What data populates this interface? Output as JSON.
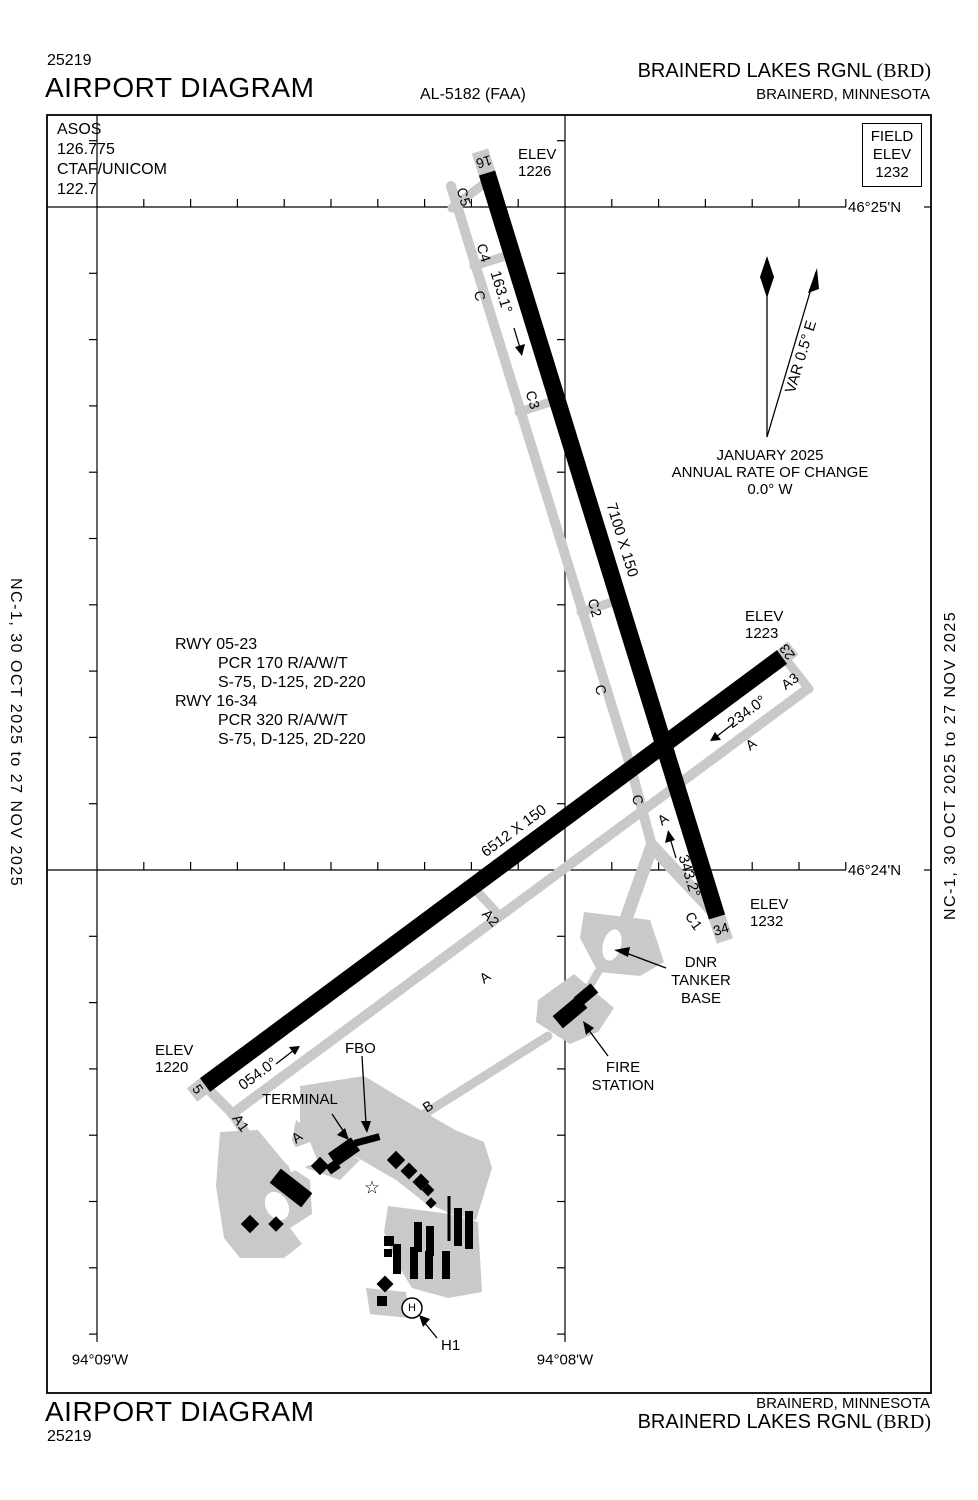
{
  "colors": {
    "ink": "#000000",
    "taxiway_gray": "#c9c9c9",
    "paper": "#ffffff"
  },
  "header": {
    "doc_number": "25219",
    "title": "AIRPORT DIAGRAM",
    "chart_code": "AL-5182 (FAA)",
    "airport_name": "BRAINERD LAKES RGNL",
    "airport_code": "(BRD)",
    "city": "BRAINERD, MINNESOTA"
  },
  "footer": {
    "doc_number": "25219",
    "title": "AIRPORT DIAGRAM",
    "airport_name": "BRAINERD LAKES RGNL",
    "airport_code": "(BRD)",
    "city": "BRAINERD, MINNESOTA"
  },
  "margin_note": "NC-1,  30 OCT 2025  to  27 NOV 2025",
  "comms": {
    "asos_label": "ASOS",
    "asos_freq": "126.775",
    "ctaf_label": "CTAF/UNICOM",
    "ctaf_freq": "122.7"
  },
  "field_elev": {
    "label1": "FIELD",
    "label2": "ELEV",
    "value": "1232"
  },
  "graticule": {
    "lat_top": "46°25'N",
    "lat_bottom": "46°24'N",
    "lon_left": "94°09'W",
    "lon_right": "94°08'W"
  },
  "compass": {
    "date": "JANUARY 2025",
    "rate_label": "ANNUAL RATE OF CHANGE",
    "rate_value": "0.0° W",
    "variation": "VAR 0.5° E"
  },
  "runway_info": {
    "rwy0523": "RWY 05-23",
    "rwy0523_pcr": "PCR 170 R/A/W/T",
    "rwy0523_wt": "S-75, D-125, 2D-220",
    "rwy1634": "RWY 16-34",
    "rwy1634_pcr": "PCR 320 R/A/W/T",
    "rwy1634_wt": "S-75, D-125, 2D-220"
  },
  "runways": {
    "r1634": {
      "end_a": "16",
      "end_b": "34",
      "dim": "7100 X 150",
      "hdg_a": "163.1°",
      "hdg_b": "343.2°"
    },
    "r0523": {
      "end_a": "5",
      "end_b": "23",
      "dim": "6512 X 150",
      "hdg_a": "054.0°",
      "hdg_b": "234.0°"
    }
  },
  "elevations": {
    "label": "ELEV",
    "rwy16": "1226",
    "rwy23": "1223",
    "rwy34": "1232",
    "rwy5": "1220"
  },
  "taxiways": {
    "c5": "C5",
    "c4": "C4",
    "c3": "C3",
    "c2": "C2",
    "c1": "C1",
    "c": "C",
    "a1": "A1",
    "a2": "A2",
    "a3": "A3",
    "a": "A",
    "b": "B"
  },
  "facilities": {
    "terminal": "TERMINAL",
    "fbo": "FBO",
    "dnr_line1": "DNR",
    "dnr_line2": "TANKER",
    "dnr_line3": "BASE",
    "fire_line1": "FIRE",
    "fire_line2": "STATION",
    "helipad": "H1",
    "helipad_symbol": "H"
  },
  "icons": {
    "star": "☆"
  }
}
